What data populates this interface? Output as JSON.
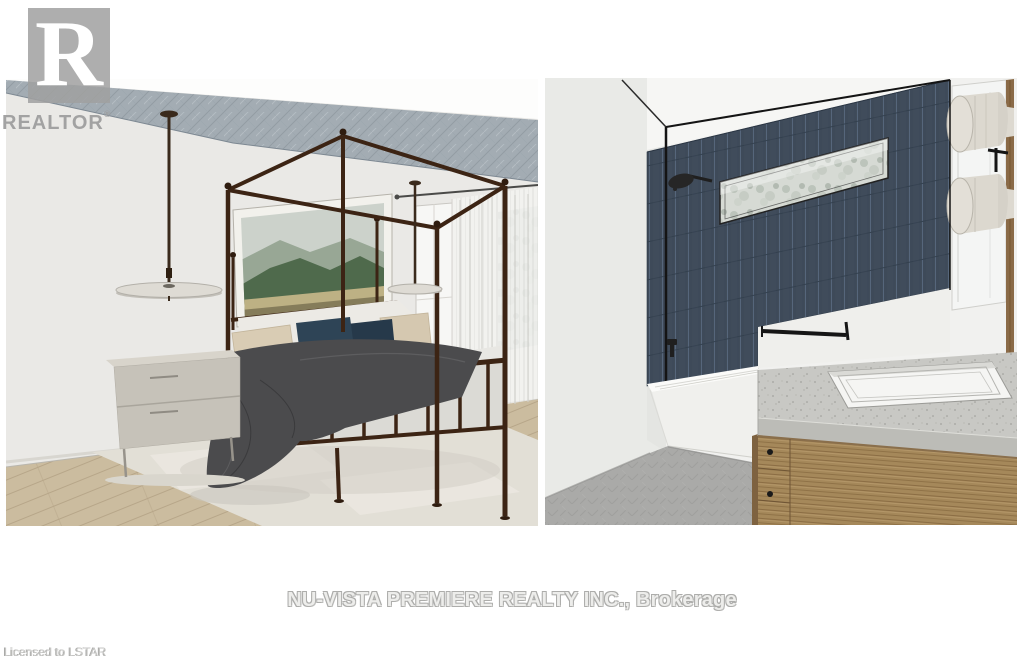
{
  "page": {
    "type": "real-estate-listing-photo",
    "subject": "3D interior rendering, bedroom and bathroom side-by-side"
  },
  "watermarks": {
    "realtor_logo": {
      "letter": "R",
      "label": "REALTOR",
      "registered_mark": "®"
    },
    "brokerage_line": "NU-VISTA PREMIERE REALTY INC., Brokerage",
    "license_line": "Licensed to LSTAR"
  },
  "scene": {
    "left_panel": {
      "name": "bedroom-rendering",
      "elements": [
        "four-poster-bed",
        "charcoal-duvet",
        "navy-and-beige-pillows",
        "mountain-artwork",
        "two-pendant-lights",
        "gray-dresser",
        "nightstand",
        "sheer-curtains",
        "textured-ceiling",
        "wood-floor-with-area-rug"
      ]
    },
    "right_panel": {
      "name": "bathroom-rendering",
      "elements": [
        "navy-tile-shower-wall",
        "black-framed-glass-panel",
        "shower-head",
        "frosted-window",
        "white-bathtub",
        "wood-vanity",
        "speckled-counter",
        "undermount-sink",
        "mirror-with-cylinder-sconces",
        "towel-bar",
        "gray-herringbone-floor"
      ]
    }
  },
  "colors": {
    "tile_navy": "#3e4a59",
    "bed_frame_brown": "#3c2414",
    "duvet_charcoal": "#4b4b4d",
    "pillow_navy": "#2e4456",
    "vanity_wood": "#a5885a",
    "ceiling_gray_blue": "#a3acb3"
  }
}
